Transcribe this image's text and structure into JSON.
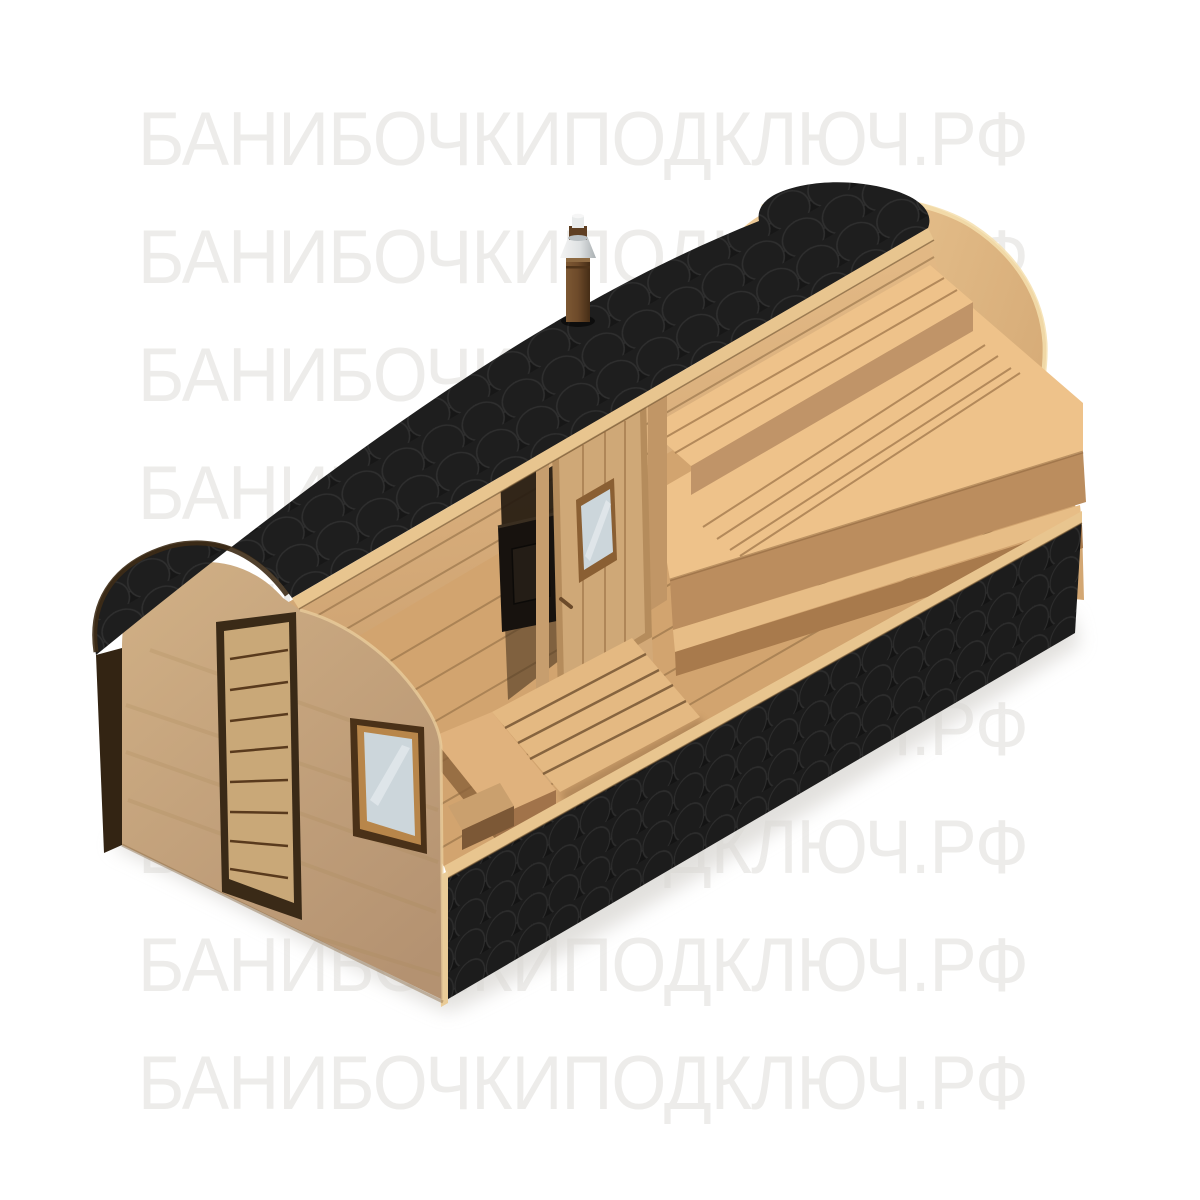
{
  "watermark": {
    "text": "БАНИБОЧКИПОДКЛЮЧ.РФ",
    "rows": 9
  },
  "scene": {
    "subject": "cutaway 3D render of a rectangular quadro barrel sauna",
    "parts": {
      "roof": "black fish-scale shingle roof",
      "chimney": "stove chimney with stainless cap",
      "front_door": "planked entrance door",
      "front_window": "square front window",
      "interior_door": "glazed interior sauna door",
      "benches": "two-tier sauna benches",
      "stove": "wood-fired sauna stove",
      "skirt": "black fish-scale shingle lower band",
      "rear_windows": "two small windows in the back wall",
      "duckboard": "slatted floor deck in entrance room"
    },
    "colors": {
      "bg": "#ffffff",
      "wm": "#edecea",
      "roof_base": "#171717",
      "roof_scale": "#1e1e1e",
      "roof_line": "#2f2f2f",
      "band_base": "#141414",
      "band_scale": "#1c1c1c",
      "band_line": "#2d2d2d",
      "face": "#c6a67d",
      "face_dark": "#a98758",
      "trim_light": "#e8c58f",
      "edge_dark": "#332413",
      "wall_int": "#e2b884",
      "wall_int_dark": "#cfa473",
      "rear_wall": "#eecb97",
      "rear_wall_dark": "#d3a773",
      "rim_light": "#f5dfae",
      "floor": "#d2a46f",
      "plank_gap": "#8a6740",
      "bench_top": "#eec28a",
      "bench_front": "#c09468",
      "bench_gap": "#9a7046",
      "riser": "#a87a4c",
      "glass": "#ccd6db",
      "glass_frame": "#b8864a",
      "frame_dark": "#4a3118",
      "stove": "#17120e",
      "metal": "#e9ebeb",
      "metal_dark": "#b9bfc2",
      "pipe": "#6d4a2a",
      "shadow": "#d8d6d2",
      "int_shadow": "#241a10"
    }
  }
}
